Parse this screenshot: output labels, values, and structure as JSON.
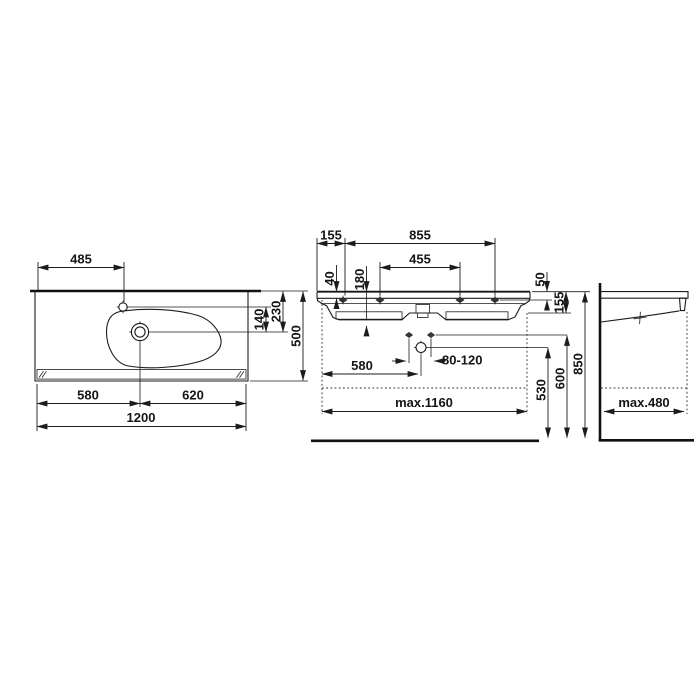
{
  "drawing_type": "washbasin-technical-drawing",
  "colors": {
    "line": "#1c1c1c",
    "background": "#ffffff"
  },
  "plan": {
    "faucet_offset": "485",
    "faucet_to_drain": "140",
    "edge_to_drain_depth": "230",
    "depth": "500",
    "left_to_drain": "580",
    "drain_to_right": "620",
    "width": "1200"
  },
  "front": {
    "edge_to_first_hole": "155",
    "outer_holes_span": "855",
    "inner_holes_span": "455",
    "rim_thickness": "40",
    "bowl_depth": "180",
    "top_to_fixing": "50",
    "apron_height": "155",
    "bolt_spacing": "80-120",
    "edge_to_drain": "580",
    "max_clearance_width": "max.1160",
    "drain_outlet_height": "530",
    "fixing_bolt_height": "600",
    "rim_height": "850"
  },
  "side": {
    "max_clearance_depth": "max.480"
  }
}
